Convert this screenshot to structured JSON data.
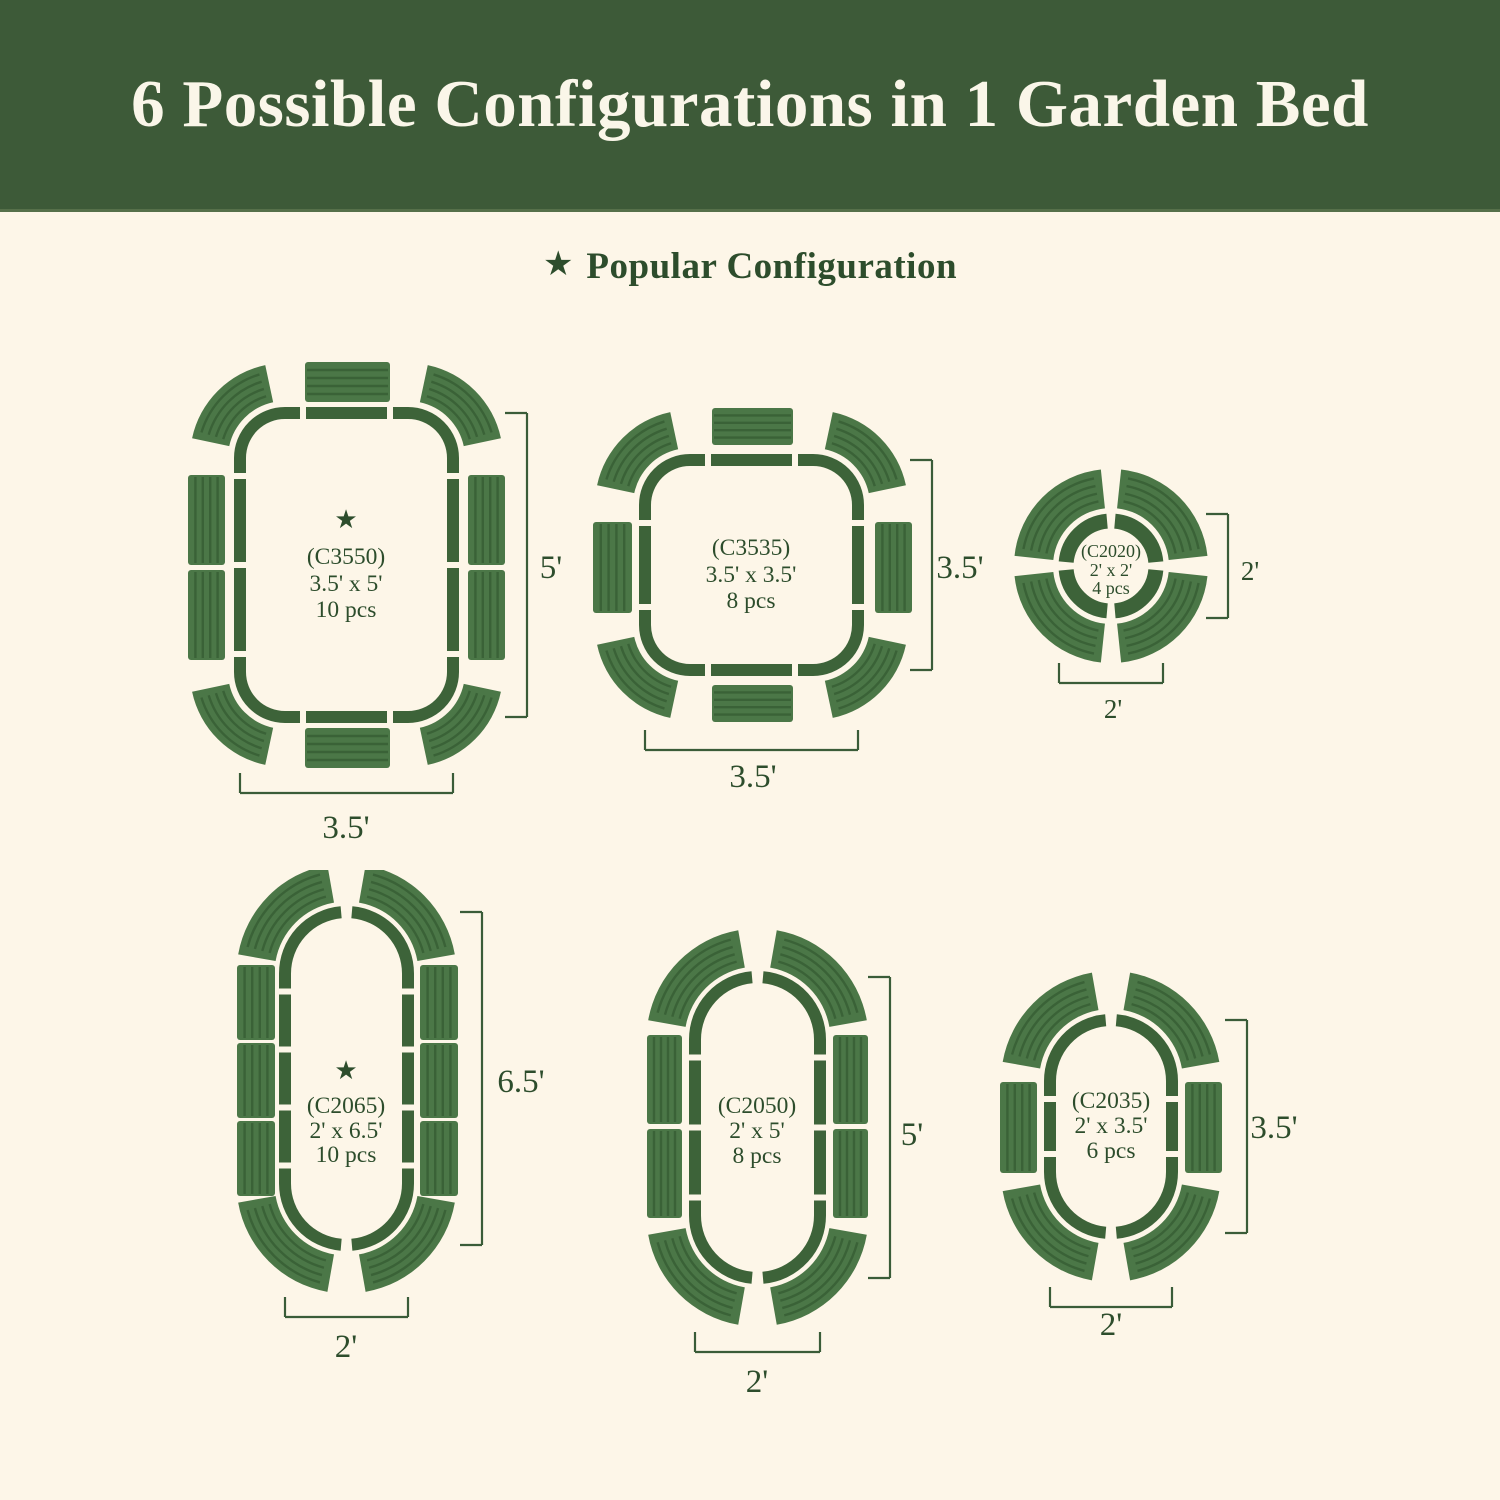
{
  "title": "6 Possible Configurations in 1 Garden Bed",
  "legend": {
    "star_icon": "★",
    "label": "Popular Configuration"
  },
  "colors": {
    "banner": "#3d5a38",
    "background": "#fdf6e8",
    "title_text": "#faf6e9",
    "text": "#2d4d2c",
    "bed_outline": "#3d6339",
    "panel_fill": "#4b7747",
    "panel_stripe": "#3a6237",
    "dimension": "#3a5c38"
  },
  "configs": [
    {
      "id": "C3550",
      "code": "(C3550)",
      "size": "3.5' x 5'",
      "pieces": "10 pcs",
      "popular": true,
      "height_label": "5'",
      "width_label": "3.5'",
      "shape": "rounded-rect"
    },
    {
      "id": "C3535",
      "code": "(C3535)",
      "size": "3.5' x 3.5'",
      "pieces": "8 pcs",
      "popular": false,
      "height_label": "3.5'",
      "width_label": "3.5'",
      "shape": "rounded-square"
    },
    {
      "id": "C2020",
      "code": "(C2020)",
      "size": "2' x 2'",
      "pieces": "4 pcs",
      "popular": false,
      "height_label": "2'",
      "width_label": "2'",
      "shape": "circle"
    },
    {
      "id": "C2065",
      "code": "(C2065)",
      "size": "2' x 6.5'",
      "pieces": "10 pcs",
      "popular": true,
      "height_label": "6.5'",
      "width_label": "2'",
      "shape": "capsule"
    },
    {
      "id": "C2050",
      "code": "(C2050)",
      "size": "2' x 5'",
      "pieces": "8 pcs",
      "popular": false,
      "height_label": "5'",
      "width_label": "2'",
      "shape": "capsule"
    },
    {
      "id": "C2035",
      "code": "(C2035)",
      "size": "2' x 3.5'",
      "pieces": "6 pcs",
      "popular": false,
      "height_label": "3.5'",
      "width_label": "2'",
      "shape": "capsule"
    }
  ]
}
